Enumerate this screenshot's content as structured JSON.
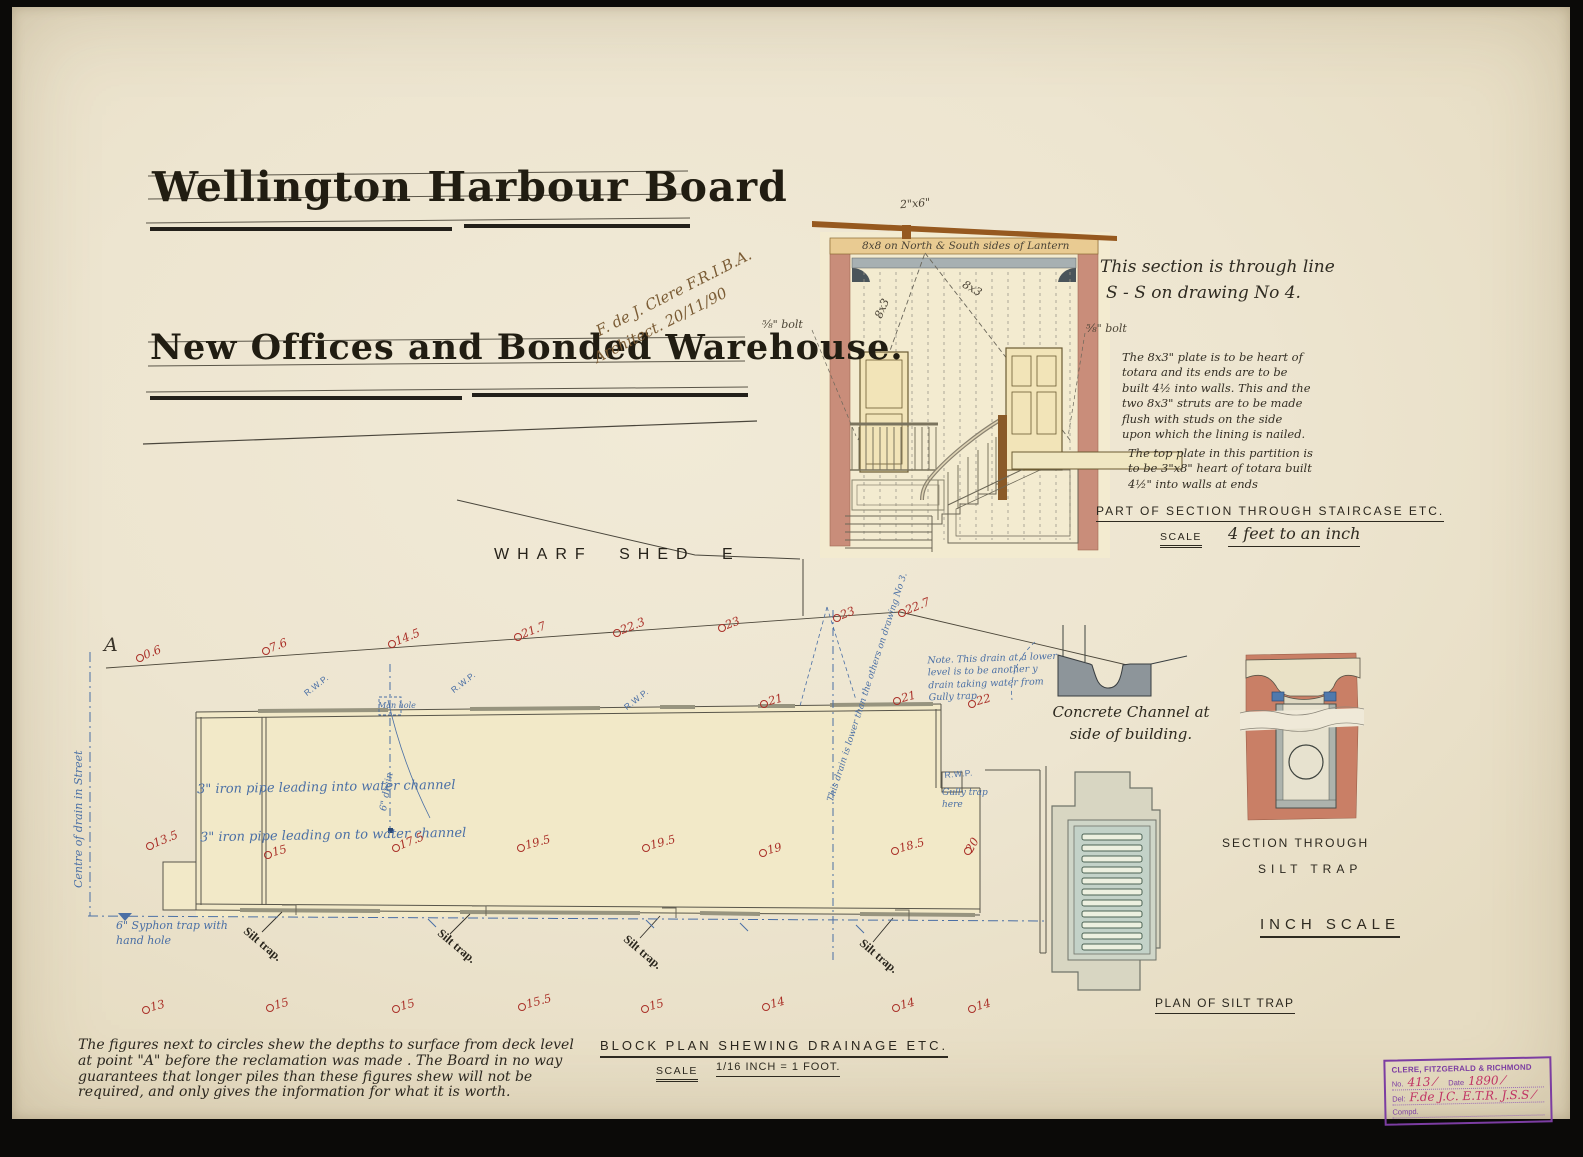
{
  "document": {
    "title_line1": "Wellington Harbour Board",
    "title_line2": "New Offices and Bonded Warehouse.",
    "signature_line1": "F. de J. Clere  F.R.I.B.A.",
    "signature_line2": "Architect.   20/11/90"
  },
  "staircase_section": {
    "roof_label": "2\"x6\"",
    "beam_label": "8x8 on North & South sides of Lantern",
    "brace_label_left": "8x3",
    "brace_label_right": "8x3",
    "bolt_label_left": "⅝\" bolt",
    "bolt_label_right": "⅝\" bolt",
    "section_note_line1": "This section is through line",
    "section_note_line2": "S - S on drawing No 4.",
    "plate_note": "The 8x3\" plate is to be heart of totara and its ends are to be built 4½ into walls. This and the two 8x3\" struts are to be made flush with studs on the side upon which the lining is nailed.",
    "top_plate_note": "The top plate in this partition is to be 3\"x8\" heart of totara built 4½\" into walls at ends",
    "caption": "PART OF SECTION THROUGH STAIRCASE ETC.",
    "scale_label": "SCALE",
    "scale_value": "4 feet to an inch"
  },
  "wharf": {
    "label": "WHARF SHED E",
    "point_label": "A"
  },
  "block_plan": {
    "caption": "BLOCK PLAN SHEWING DRAINAGE ETC.",
    "scale_label": "SCALE",
    "scale_value": "1/16 INCH = 1 FOOT.",
    "pipe_note_1": "3\" iron pipe leading into water channel",
    "pipe_note_2": "3\" iron pipe leading on to water channel",
    "syphon_note": "6\" Syphon trap with hand hole",
    "street_note": "Centre of drain in Street",
    "manhole_label": "Man hole",
    "gully_note": "Gully trap here",
    "drain_note": "Note. This drain at a lower level is to be another y drain taking water from Gully trap",
    "drain_note_2": "This drain is lower than the others on drawing No 3.",
    "drain_size_label": "6\" drain",
    "rwp_text": "R.W.P.",
    "silt_trap_text": "Silt trap.",
    "rwp_labels": [
      {
        "x": 302,
        "y": 690,
        "rot": -38
      },
      {
        "x": 449,
        "y": 687,
        "rot": -38
      },
      {
        "x": 622,
        "y": 704,
        "rot": -38
      },
      {
        "x": 944,
        "y": 770,
        "rot": -5
      }
    ],
    "silt_trap_labels": [
      {
        "x": 250,
        "y": 924
      },
      {
        "x": 444,
        "y": 926
      },
      {
        "x": 630,
        "y": 932
      },
      {
        "x": 866,
        "y": 936
      }
    ],
    "depth_markers": [
      {
        "value": "0.6",
        "x": 136,
        "y": 650,
        "rot": -22
      },
      {
        "value": "7.6",
        "x": 262,
        "y": 643,
        "rot": -22
      },
      {
        "value": "14.5",
        "x": 388,
        "y": 636,
        "rot": -22
      },
      {
        "value": "21.7",
        "x": 514,
        "y": 629,
        "rot": -22
      },
      {
        "value": "22.3",
        "x": 613,
        "y": 625,
        "rot": -22
      },
      {
        "value": "23",
        "x": 718,
        "y": 620,
        "rot": -22
      },
      {
        "value": "23",
        "x": 833,
        "y": 610,
        "rot": -22
      },
      {
        "value": "22.7",
        "x": 898,
        "y": 605,
        "rot": -22
      },
      {
        "value": "21",
        "x": 760,
        "y": 696,
        "rot": -15
      },
      {
        "value": "21",
        "x": 893,
        "y": 693,
        "rot": -15
      },
      {
        "value": "22",
        "x": 968,
        "y": 696,
        "rot": -15
      },
      {
        "value": "13.5",
        "x": 146,
        "y": 838,
        "rot": -22
      },
      {
        "value": "15",
        "x": 264,
        "y": 847,
        "rot": -15
      },
      {
        "value": "17.5",
        "x": 392,
        "y": 840,
        "rot": -22
      },
      {
        "value": "19.5",
        "x": 517,
        "y": 840,
        "rot": -15
      },
      {
        "value": "19.5",
        "x": 642,
        "y": 840,
        "rot": -15
      },
      {
        "value": "19",
        "x": 759,
        "y": 845,
        "rot": -15
      },
      {
        "value": "18.5",
        "x": 891,
        "y": 843,
        "rot": -15
      },
      {
        "value": "20",
        "x": 964,
        "y": 843,
        "rot": -60
      },
      {
        "value": "13",
        "x": 142,
        "y": 1002,
        "rot": -15
      },
      {
        "value": "15",
        "x": 266,
        "y": 1000,
        "rot": -15
      },
      {
        "value": "15",
        "x": 392,
        "y": 1001,
        "rot": -15
      },
      {
        "value": "15.5",
        "x": 518,
        "y": 999,
        "rot": -15
      },
      {
        "value": "15",
        "x": 641,
        "y": 1001,
        "rot": -15
      },
      {
        "value": "14",
        "x": 762,
        "y": 999,
        "rot": -15
      },
      {
        "value": "14",
        "x": 892,
        "y": 1000,
        "rot": -15
      },
      {
        "value": "14",
        "x": 968,
        "y": 1001,
        "rot": -15
      }
    ]
  },
  "details": {
    "concrete_channel_caption_1": "Concrete Channel at",
    "concrete_channel_caption_2": "side of building.",
    "silt_section_caption_1": "SECTION THROUGH",
    "silt_section_caption_2": "SILT TRAP",
    "inch_scale_label": "INCH SCALE",
    "silt_plan_caption": "PLAN OF SILT TRAP"
  },
  "footnote": "The figures next to circles shew the depths to surface from deck level at point \"A\" before the reclamation was made .   The Board in no way guarantees  that longer piles than these figures shew will not be required, and only gives the information for what it is worth.",
  "stamp": {
    "firm": "CLERE, FITZGERALD & RICHMOND",
    "no_label": "No.",
    "no_value": "413 ⁄",
    "date_label": "Date",
    "date_value": "1890 ⁄",
    "del_label": "Del:",
    "del_value": "F.de J.C.   E.T.R.   J.S.S ⁄",
    "comp_label": "Compd."
  },
  "colors": {
    "paper": "#ece4d0",
    "ink": "#2e2a20",
    "pile_red": "#aa3028",
    "drain_blue": "#4a6fa5",
    "wall_pink": "#c98d7a",
    "roof_brown": "#8a5420",
    "concrete_grey": "#8d959a",
    "stamp_purple": "#7c3da2",
    "stamp_magenta": "#c13364"
  }
}
